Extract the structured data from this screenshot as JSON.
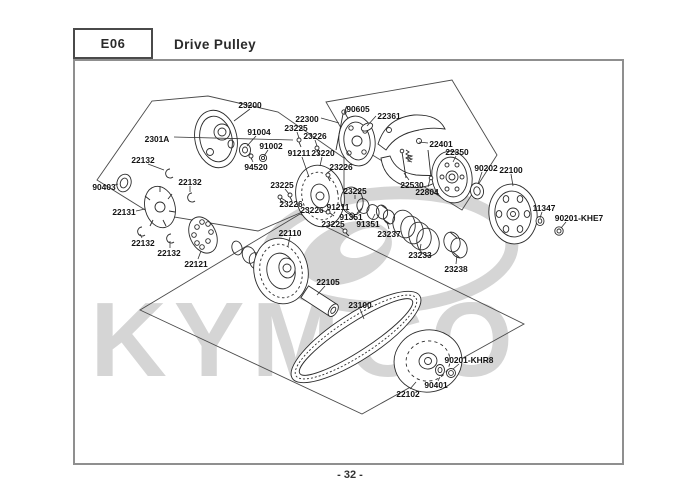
{
  "header": {
    "code": "E06",
    "title": "Drive Pulley"
  },
  "footer": {
    "page": "- 32 -"
  },
  "watermark": {
    "text": "KYMCO",
    "color": "#cbcbcb"
  },
  "colors": {
    "line": "#2b2b2b",
    "label": "#121212",
    "border": "#8f8f8f"
  },
  "diagram": {
    "labels": [
      {
        "text": "23200",
        "x": 250,
        "y": 105,
        "leader": [
          250,
          109,
          234,
          121
        ]
      },
      {
        "text": "2301A",
        "x": 157,
        "y": 139,
        "leader": [
          174,
          137,
          293,
          140
        ]
      },
      {
        "text": "91004",
        "x": 259,
        "y": 132,
        "leader": [
          256,
          136,
          247,
          146
        ]
      },
      {
        "text": "91002",
        "x": 271,
        "y": 146,
        "leader": [
          268,
          150,
          264,
          156
        ]
      },
      {
        "text": "94520",
        "x": 256,
        "y": 167,
        "leader": [
          253,
          162,
          251,
          158
        ]
      },
      {
        "text": "22300",
        "x": 307,
        "y": 119,
        "leader": [
          321,
          118,
          339,
          123
        ]
      },
      {
        "text": "90605",
        "x": 358,
        "y": 109,
        "leader": [
          345,
          110,
          344,
          114
        ]
      },
      {
        "text": "22361",
        "x": 389,
        "y": 116,
        "leader": [
          376,
          116,
          367,
          126
        ]
      },
      {
        "text": "22401",
        "x": 441,
        "y": 144,
        "leader": [
          428,
          143,
          419,
          142
        ]
      },
      {
        "text": "22350",
        "x": 457,
        "y": 152,
        "leader": [
          456,
          156,
          453,
          162
        ]
      },
      {
        "text": "90202",
        "x": 486,
        "y": 168,
        "leader": [
          482,
          172,
          478,
          184
        ]
      },
      {
        "text": "22100",
        "x": 511,
        "y": 170,
        "leader": [
          511,
          174,
          513,
          186
        ]
      },
      {
        "text": "22530",
        "x": 412,
        "y": 185,
        "leader": [
          409,
          180,
          404,
          173
        ]
      },
      {
        "text": "22804",
        "x": 427,
        "y": 192,
        "leader": [
          428,
          187,
          430,
          179
        ]
      },
      {
        "text": "11347",
        "x": 544,
        "y": 208,
        "leader": [
          542,
          212,
          540,
          218
        ]
      },
      {
        "text": "90201-KHE7",
        "x": 579,
        "y": 218,
        "leader": [
          566,
          222,
          561,
          228
        ]
      },
      {
        "text": "22132",
        "x": 143,
        "y": 160,
        "leader": [
          148,
          164,
          164,
          170
        ]
      },
      {
        "text": "90403",
        "x": 104,
        "y": 187,
        "leader": [
          115,
          185,
          118,
          184
        ]
      },
      {
        "text": "22132",
        "x": 190,
        "y": 182,
        "leader": [
          190,
          186,
          190,
          192
        ]
      },
      {
        "text": "22131",
        "x": 124,
        "y": 212,
        "leader": [
          136,
          211,
          145,
          209
        ]
      },
      {
        "text": "22132",
        "x": 143,
        "y": 243,
        "leader": [
          142,
          238,
          140,
          234
        ]
      },
      {
        "text": "22132",
        "x": 169,
        "y": 253,
        "leader": [
          170,
          248,
          170,
          241
        ]
      },
      {
        "text": "22121",
        "x": 196,
        "y": 264,
        "leader": [
          198,
          259,
          201,
          251
        ]
      },
      {
        "text": "23225",
        "x": 296,
        "y": 128,
        "leader": [
          297,
          132,
          299,
          138
        ]
      },
      {
        "text": "23226",
        "x": 315,
        "y": 136,
        "leader": [
          315,
          140,
          317,
          146
        ]
      },
      {
        "text": "91211",
        "x": 299,
        "y": 153,
        "leader": [
          302,
          157,
          309,
          177
        ]
      },
      {
        "text": "23220",
        "x": 323,
        "y": 153,
        "leader": [
          322,
          157,
          320,
          166
        ]
      },
      {
        "text": "23226",
        "x": 341,
        "y": 167,
        "leader": [
          333,
          169,
          327,
          173
        ]
      },
      {
        "text": "23225",
        "x": 282,
        "y": 185,
        "leader": [
          285,
          189,
          289,
          194
        ]
      },
      {
        "text": "23226",
        "x": 291,
        "y": 204,
        "leader": [
          286,
          201,
          281,
          198
        ]
      },
      {
        "text": "23226",
        "x": 312,
        "y": 210,
        "leader": [
          321,
          210,
          327,
          212
        ]
      },
      {
        "text": "91211",
        "x": 338,
        "y": 207,
        "leader": [
          346,
          210,
          351,
          214
        ]
      },
      {
        "text": "23225",
        "x": 333,
        "y": 224,
        "leader": [
          339,
          226,
          344,
          230
        ]
      },
      {
        "text": "23225",
        "x": 355,
        "y": 191,
        "leader": [
          355,
          195,
          355,
          199
        ]
      },
      {
        "text": "91351",
        "x": 351,
        "y": 217,
        "leader": [
          357,
          213,
          362,
          208
        ]
      },
      {
        "text": "91351",
        "x": 368,
        "y": 224,
        "leader": [
          372,
          220,
          375,
          214
        ]
      },
      {
        "text": "23237",
        "x": 389,
        "y": 234,
        "leader": [
          389,
          229,
          387,
          222
        ]
      },
      {
        "text": "23233",
        "x": 420,
        "y": 255,
        "leader": [
          420,
          250,
          421,
          244
        ]
      },
      {
        "text": "23238",
        "x": 456,
        "y": 269,
        "leader": [
          456,
          264,
          457,
          255
        ]
      },
      {
        "text": "22110",
        "x": 290,
        "y": 233,
        "leader": [
          290,
          237,
          288,
          246
        ]
      },
      {
        "text": "22105",
        "x": 328,
        "y": 282,
        "leader": [
          325,
          286,
          317,
          295
        ]
      },
      {
        "text": "23100",
        "x": 360,
        "y": 305,
        "leader": [
          360,
          309,
          364,
          319
        ]
      },
      {
        "text": "22102",
        "x": 408,
        "y": 394,
        "leader": [
          410,
          389,
          416,
          382
        ]
      },
      {
        "text": "90401",
        "x": 436,
        "y": 385,
        "leader": [
          438,
          381,
          440,
          377
        ]
      },
      {
        "text": "90201-KHR8",
        "x": 469,
        "y": 360,
        "leader": [
          459,
          364,
          453,
          369
        ]
      }
    ]
  }
}
